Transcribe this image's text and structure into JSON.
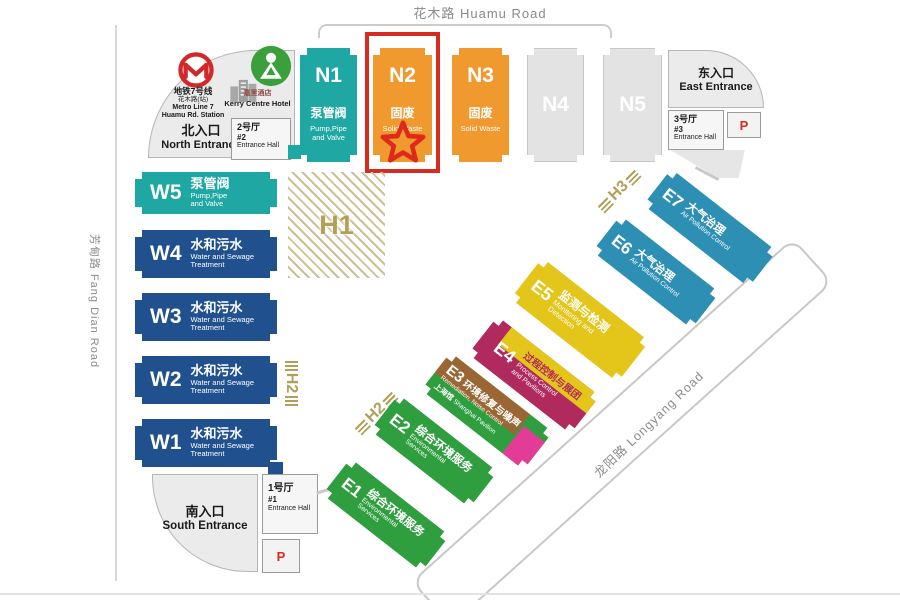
{
  "roads": {
    "top": "花木路 Huamu Road",
    "left": "芳甸路 Fang Dian Road",
    "diagonal": "龙阳路 Longyang Road"
  },
  "north_entrance": {
    "name_cn": "北入口",
    "name_en": "North Entrance",
    "metro": {
      "line_cn": "地铁7号线",
      "station_cn": "花木路(站)",
      "line_en": "Metro Line 7",
      "station_en": "Huamu Rd. Station"
    },
    "hotel": {
      "cn": "嘉里酒店",
      "en": "Kerry Centre Hotel"
    },
    "hall": {
      "cn": "2号厅",
      "num": "#2",
      "en": "Entrance Hall"
    }
  },
  "east_entrance": {
    "name_cn": "东入口",
    "name_en": "East Entrance",
    "hall": {
      "cn": "3号厅",
      "num": "#3",
      "en": "Entrance Hall"
    },
    "parking": "P"
  },
  "south_entrance": {
    "name_cn": "南入口",
    "name_en": "South Entrance",
    "hall": {
      "cn": "1号厅",
      "num": "#1",
      "en": "Entrance Hall"
    },
    "parking": "P"
  },
  "halls_n": [
    {
      "id": "N1",
      "cn": "泵管阀",
      "en1": "Pump,Pipe",
      "en2": "and Valve"
    },
    {
      "id": "N2",
      "cn": "固废",
      "en1": "Solid Waste"
    },
    {
      "id": "N3",
      "cn": "固废",
      "en1": "Solid Waste"
    },
    {
      "id": "N4"
    },
    {
      "id": "N5"
    }
  ],
  "halls_w": [
    {
      "id": "W5",
      "cn": "泵管阀",
      "en1": "Pump,Pipe",
      "en2": "and Valve"
    },
    {
      "id": "W4",
      "cn": "水和污水",
      "en1": "Water and Sewage",
      "en2": "Treatment"
    },
    {
      "id": "W3",
      "cn": "水和污水",
      "en1": "Water and Sewage",
      "en2": "Treatment"
    },
    {
      "id": "W2",
      "cn": "水和污水",
      "en1": "Water and Sewage",
      "en2": "Treatment"
    },
    {
      "id": "W1",
      "cn": "水和污水",
      "en1": "Water and Sewage",
      "en2": "Treatment"
    }
  ],
  "halls_e": [
    {
      "id": "E1",
      "cn": "综合环境服务",
      "en": "Environmental",
      "en2": "Services"
    },
    {
      "id": "E2",
      "cn": "综合环境服务",
      "en": "Environmental",
      "en2": "Services"
    },
    {
      "id": "E3",
      "cn": "环境修复与噪声",
      "en": "Remediation, Noise Control",
      "sub_cn": "上海馆",
      "sub_en": "Shanghai Pavilion"
    },
    {
      "id": "E4",
      "cn": "过程控制与展团",
      "en": "Process Control",
      "en2": "and Pavilions"
    },
    {
      "id": "E5",
      "cn": "监测与检测",
      "en": "Monitoring and",
      "en2": "Detection"
    },
    {
      "id": "E6",
      "cn": "大气治理",
      "en": "Air Pollution Control"
    },
    {
      "id": "E7",
      "cn": "大气治理",
      "en": "Air Pollution Control"
    }
  ],
  "zones": {
    "h1": "H1",
    "h2_west": "H2",
    "h2_east": "H2",
    "h3": "H3"
  },
  "colors": {
    "teal": "#1fa8a3",
    "dark_blue": "#21508f",
    "orange": "#f0992e",
    "gray_hall": "#e3e3e3",
    "green": "#2f9e3f",
    "yellow": "#e4c51a",
    "blue": "#2e8fb5",
    "magenta": "#b12a5e",
    "brown": "#9a6734",
    "pink": "#e23c96",
    "gold": "#b3a057",
    "highlight_red": "#d52b20"
  }
}
